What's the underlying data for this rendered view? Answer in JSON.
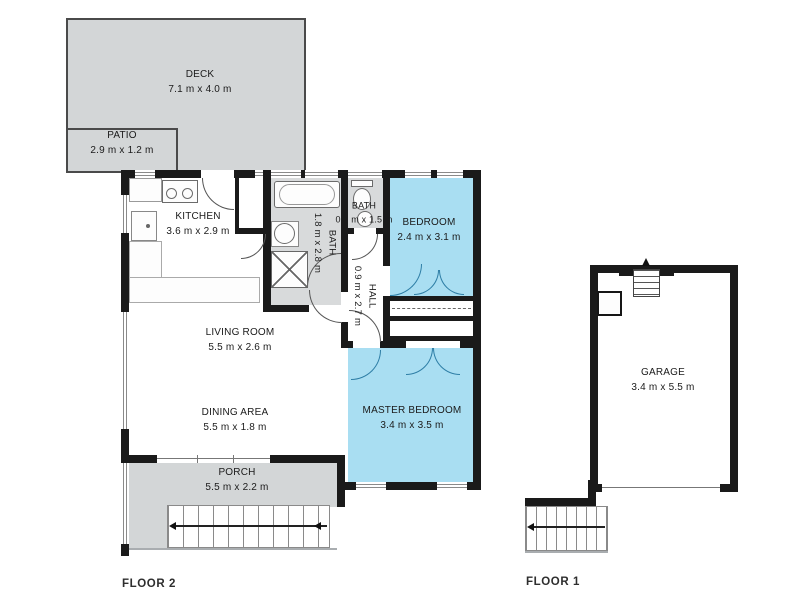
{
  "floors": {
    "floor2": {
      "label": "FLOOR 2"
    },
    "floor1": {
      "label": "FLOOR 1"
    }
  },
  "rooms": {
    "deck": {
      "name": "DECK",
      "dims": "7.1 m x 4.0 m"
    },
    "patio": {
      "name": "PATIO",
      "dims": "2.9 m x 1.2 m"
    },
    "kitchen": {
      "name": "KITCHEN",
      "dims": "3.6 m x 2.9 m"
    },
    "bath": {
      "name": "BATH",
      "dims": "1.8 m x 2.8 m"
    },
    "bath_small": {
      "name": "BATH",
      "dims": "0.9 m x 1.5 m"
    },
    "bedroom": {
      "name": "BEDROOM",
      "dims": "2.4 m x 3.1 m"
    },
    "hall": {
      "name": "HALL",
      "dims": "0.9 m x 2.7 m"
    },
    "living": {
      "name": "LIVING ROOM",
      "dims": "5.5 m x 2.6 m"
    },
    "dining": {
      "name": "DINING AREA",
      "dims": "5.5 m x 1.8 m"
    },
    "master": {
      "name": "MASTER BEDROOM",
      "dims": "3.4 m x 3.5 m"
    },
    "porch": {
      "name": "PORCH",
      "dims": "5.5 m x 2.2 m"
    },
    "garage": {
      "name": "GARAGE",
      "dims": "3.4 m x 5.5 m"
    }
  },
  "colors": {
    "wall": "#1a1a1a",
    "highlighted_room": "#a9def2",
    "outdoor_area": "#d3d6d7",
    "bath_floor": "#d8dadb"
  }
}
